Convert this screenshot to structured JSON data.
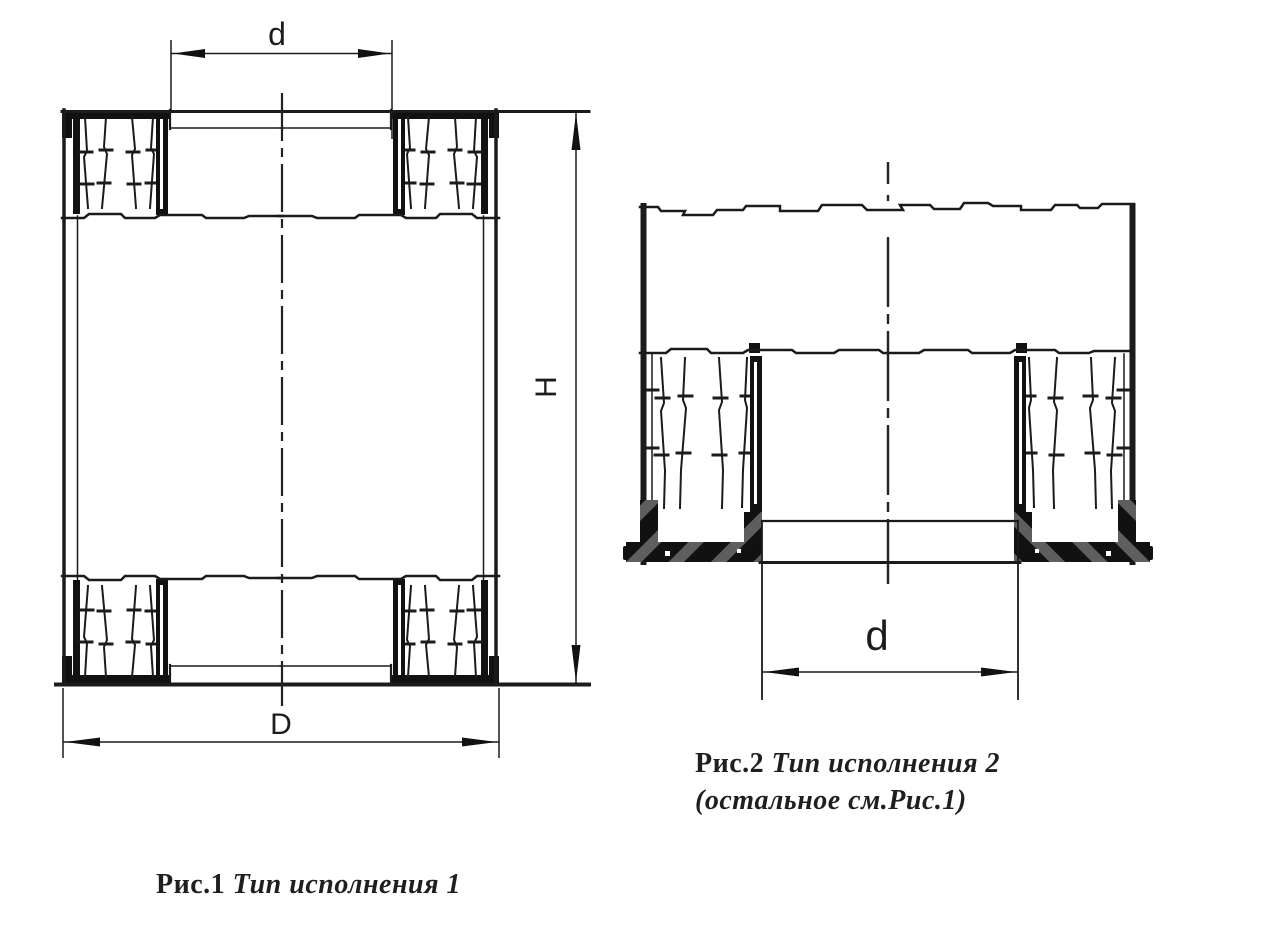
{
  "page": {
    "background": "#ffffff",
    "ink": "#1b1b1b",
    "watermark_stripe": "#5e5e5e"
  },
  "figure1": {
    "dims": {
      "top": "d",
      "bottom": "D",
      "height": "H"
    },
    "caption": {
      "label": "Рис.1",
      "title": "Тип исполнения 1"
    }
  },
  "figure2": {
    "dims": {
      "bottom": "d"
    },
    "caption": {
      "label": "Рис.2",
      "title": "Тип исполнения 2",
      "note": "(остальное см.Рис.1)"
    }
  }
}
